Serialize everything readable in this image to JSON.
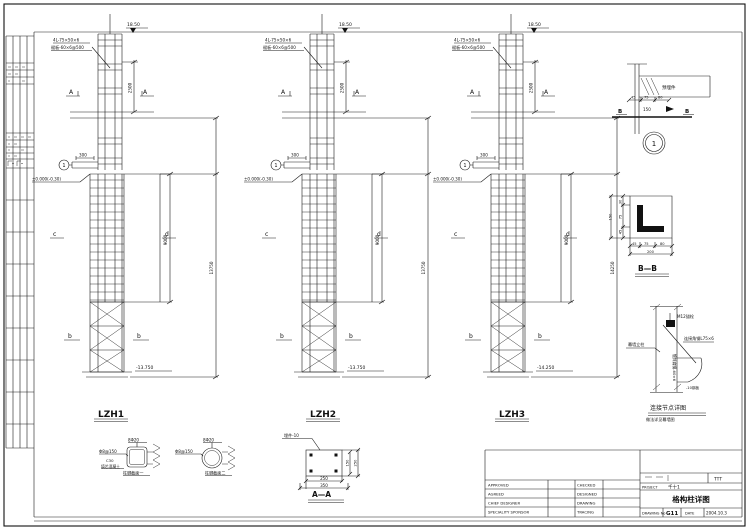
{
  "columns": [
    {
      "name": "LZH1",
      "top_elev": "18.50",
      "ann1": "4L-75×50×6",
      "ann2": "缀板-60×6@500",
      "cut": "A",
      "dim_upper": "2500",
      "beam_dim": "300",
      "bubble": "1",
      "ground_elev": "±0.000(-0.30)",
      "mid_left": "c",
      "mid_right": "d",
      "dim_embed": "9000",
      "bot_left": "b",
      "bot_right": "b",
      "base_elev": "-13.750",
      "dim_total": "13750"
    },
    {
      "name": "LZH2",
      "top_elev": "18.50",
      "ann1": "4L-75×50×6",
      "ann2": "缀板-60×6@500",
      "cut": "A",
      "dim_upper": "2500",
      "beam_dim": "300",
      "bubble": "1",
      "ground_elev": "±0.000(-0.30)",
      "mid_left": "c",
      "mid_right": "d",
      "dim_embed": "9000",
      "bot_left": "b",
      "bot_right": "b",
      "base_elev": "-13.750",
      "dim_total": "13750"
    },
    {
      "name": "LZH3",
      "top_elev": "18.50",
      "ann1": "4L-75×50×6",
      "ann2": "缀板-60×6@500",
      "cut": "A",
      "dim_upper": "2500",
      "beam_dim": "300",
      "bubble": "1",
      "ground_elev": "±0.000(-0.30)",
      "mid_left": "c",
      "mid_right": "d",
      "dim_embed": "9000",
      "bot_left": "b",
      "bot_right": "b",
      "base_elev": "-14.250",
      "dim_total": "14250"
    }
  ],
  "details": {
    "d1": {
      "beam_label": "预埋件",
      "dims": [
        "45",
        "75",
        "80"
      ],
      "below": "150",
      "flag": "B",
      "bubble": "1"
    },
    "bb": {
      "left_dims": [
        "30",
        "75",
        "45"
      ],
      "left_total": "150",
      "bottom_dims": [
        "45",
        "75",
        "80"
      ],
      "bottom_total": "200",
      "label": "B—B"
    },
    "bracket": {
      "top_label": "M12锚栓",
      "right_label": "连接角钢L75×6",
      "left_label": "幕墙立柱",
      "vert_label": "镀锌扁钢-60×6",
      "plate_note": "-10钢板",
      "title": "连接节点详图",
      "subtitle": "做法详见幕墙图"
    },
    "s1": {
      "top": "8Φ20",
      "left": "Φ8@150",
      "note1": "C30",
      "note2": "填芯混凝土",
      "bottom": "柱脚截面一"
    },
    "s2": {
      "top": "8Φ20",
      "left": "Φ8@150",
      "bottom": "柱脚截面二"
    },
    "aa": {
      "note": "埋件-10",
      "right_dim1": "150",
      "right_dim2": "250",
      "bottom_dim1": "250",
      "bottom_dim2": "350",
      "label": "A—A"
    }
  },
  "title_block": {
    "rows_left": [
      "APPROVED",
      "AGREED",
      "CHIEF DESIGNER",
      "SPECIALITY SPONSOR"
    ],
    "rows_mid": [
      "CHECKED",
      "DESIGNED",
      "DRAWING",
      "TRACING"
    ],
    "cert": "TTT",
    "project_label": "PROJECT",
    "project_value": "千十1",
    "title": "格构柱详图",
    "drawing_no_label": "DRAWING No",
    "drawing_no": "G11",
    "date_label": "DATE",
    "date": "2004.10.3"
  }
}
